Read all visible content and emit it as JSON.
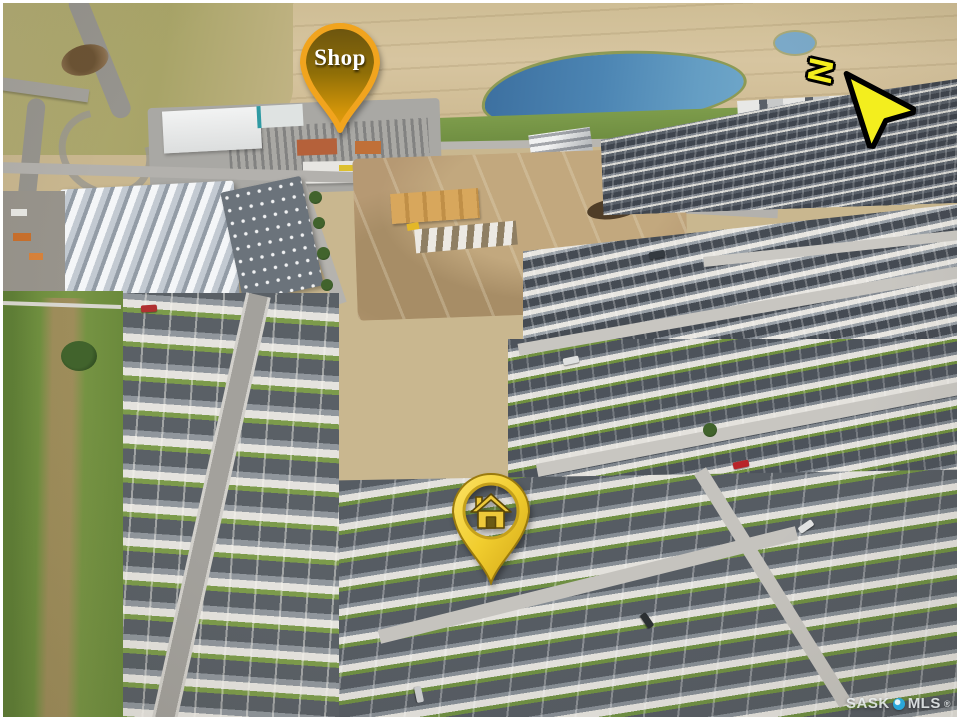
{
  "annotations": {
    "shop_pin": {
      "label": "Shop",
      "label_color": "#ffffff",
      "fill_rim": "#f1a41e",
      "fill_inner_top": "#6b540f",
      "fill_inner_bottom": "#e89d12"
    },
    "property_pin": {
      "icon": "house-icon",
      "fill": "#f1cd2e",
      "ring": "#c5a01a",
      "outline": "#9a7a0e"
    },
    "north_arrow": {
      "label": "N",
      "fill": "#f3ee1e",
      "outline": "#000000"
    }
  },
  "watermark": {
    "text_left": "SASK",
    "text_right": "MLS",
    "registered": "®",
    "dot_color": "#2aa7d9",
    "text_color": "#f0f4f6"
  },
  "scene_palette": {
    "field_tan": "#d3c09a",
    "field_olive": "#a9a468",
    "pond_blue": "#4077a9",
    "grass_green": "#6f8f3f",
    "road_gray": "#a9a7a2",
    "roof_dark": "#4a4f55",
    "concrete_light": "#e2e0db",
    "dirt_brown": "#b59872"
  }
}
